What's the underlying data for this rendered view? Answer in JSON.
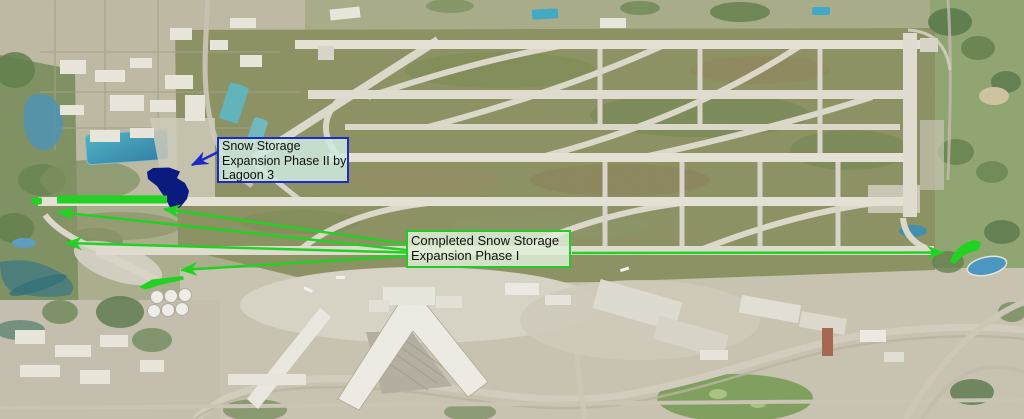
{
  "map": {
    "description": "Aerial photo of airport with snow storage expansion annotations"
  },
  "annotations": {
    "arrow_green": "#22d222",
    "arrow_blue": "#1d2ac8",
    "phase1_area_color": "#22d222",
    "phase2_area_color": "#0a1a7e",
    "phase2_box": {
      "line1": "Snow Storage",
      "line2": "Expansion Phase II by",
      "line3": "Lagoon 3",
      "border_color": "#1d2ac8",
      "fill_color": "rgba(206,233,221,0.86)",
      "text_color": "#101010"
    },
    "phase1_box": {
      "line1": "Completed Snow Storage",
      "line2": "Expansion Phase I",
      "border_color": "#28c828",
      "fill_color": "rgba(223,240,216,0.85)",
      "text_color": "#101010"
    }
  }
}
